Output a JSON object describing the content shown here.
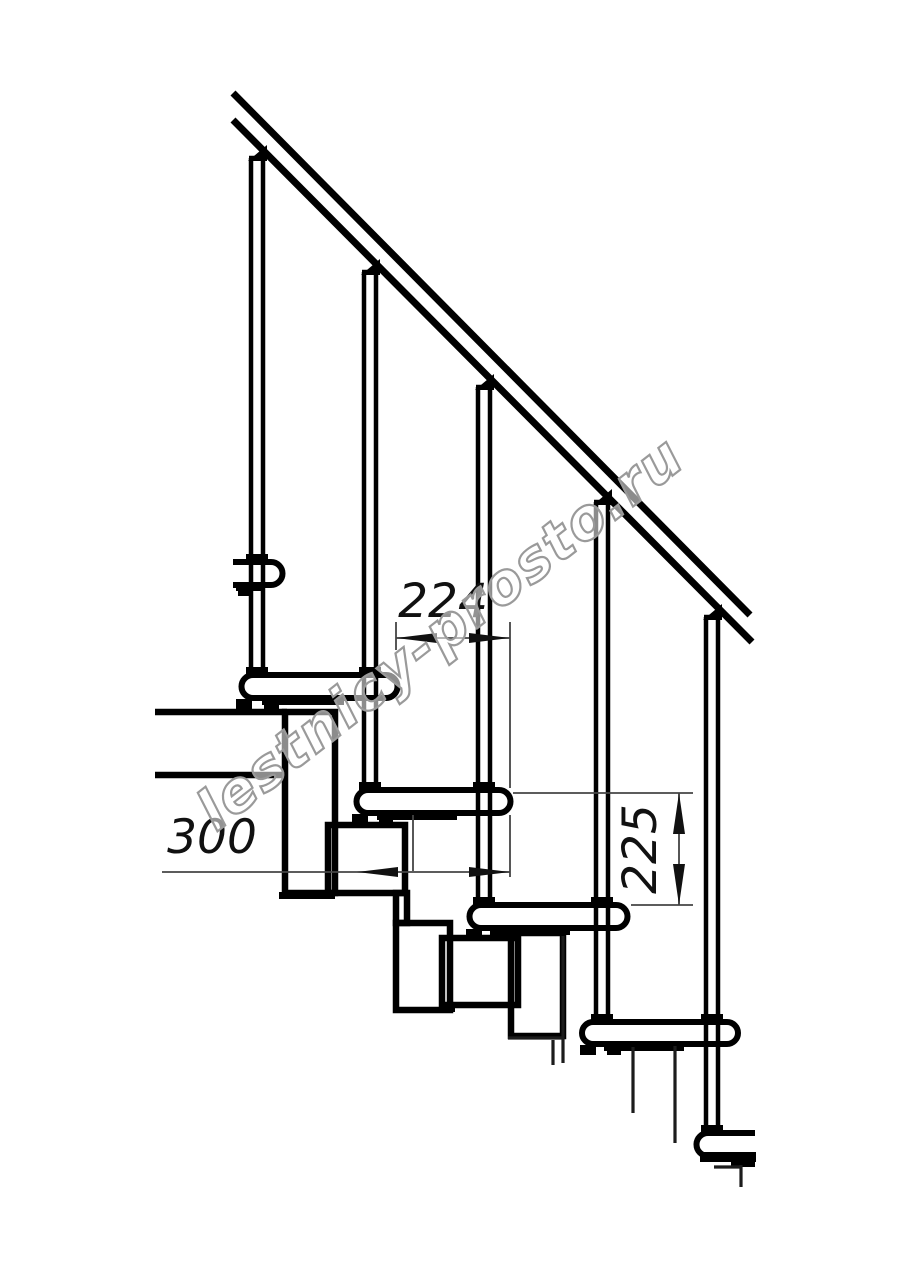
{
  "drawing": {
    "watermark": {
      "text": "lestnicy-prosto.ru"
    },
    "dimensions": {
      "going": {
        "label": "224",
        "orientation": "horizontal"
      },
      "tread_depth": {
        "label": "300",
        "orientation": "horizontal"
      },
      "rise": {
        "label": "225",
        "orientation": "vertical"
      }
    },
    "colors": {
      "background": "#ffffff",
      "outline": "#000000",
      "thin_line": "#3c3c3c",
      "dimension_line": "#444444",
      "watermark": "#9a9a9a"
    }
  }
}
